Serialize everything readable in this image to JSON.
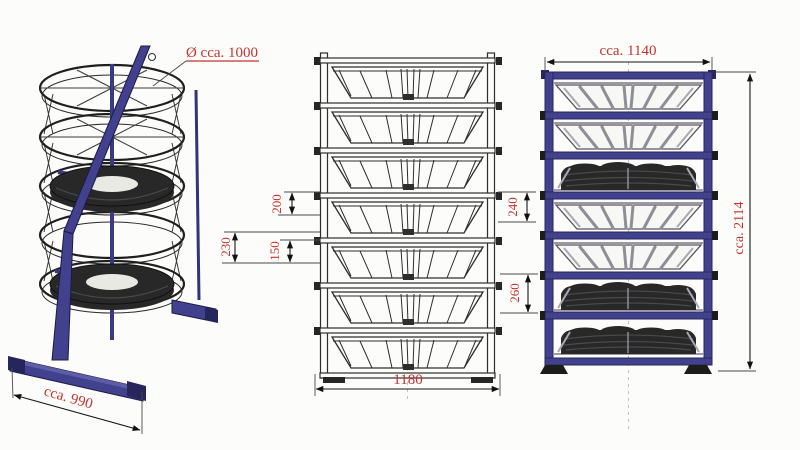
{
  "colors": {
    "dim_red": "#c23430",
    "frame_blue": "#41418e",
    "frame_blue_dark": "#26265c",
    "tire_black": "#282828",
    "paper": "#fcfcfa"
  },
  "iso_view": {
    "diameter_label": "Ø cca. 1000",
    "base_width_label": "cca. 990"
  },
  "sketch_view": {
    "dim_left_top": "200",
    "dim_left_mid": "230",
    "dim_left_bottom": "150",
    "dim_right_top": "240",
    "dim_right_bottom": "260",
    "dim_bottom_width": "1180"
  },
  "front_view": {
    "width_label": "cca. 1140",
    "height_label": "cca. 2114"
  }
}
